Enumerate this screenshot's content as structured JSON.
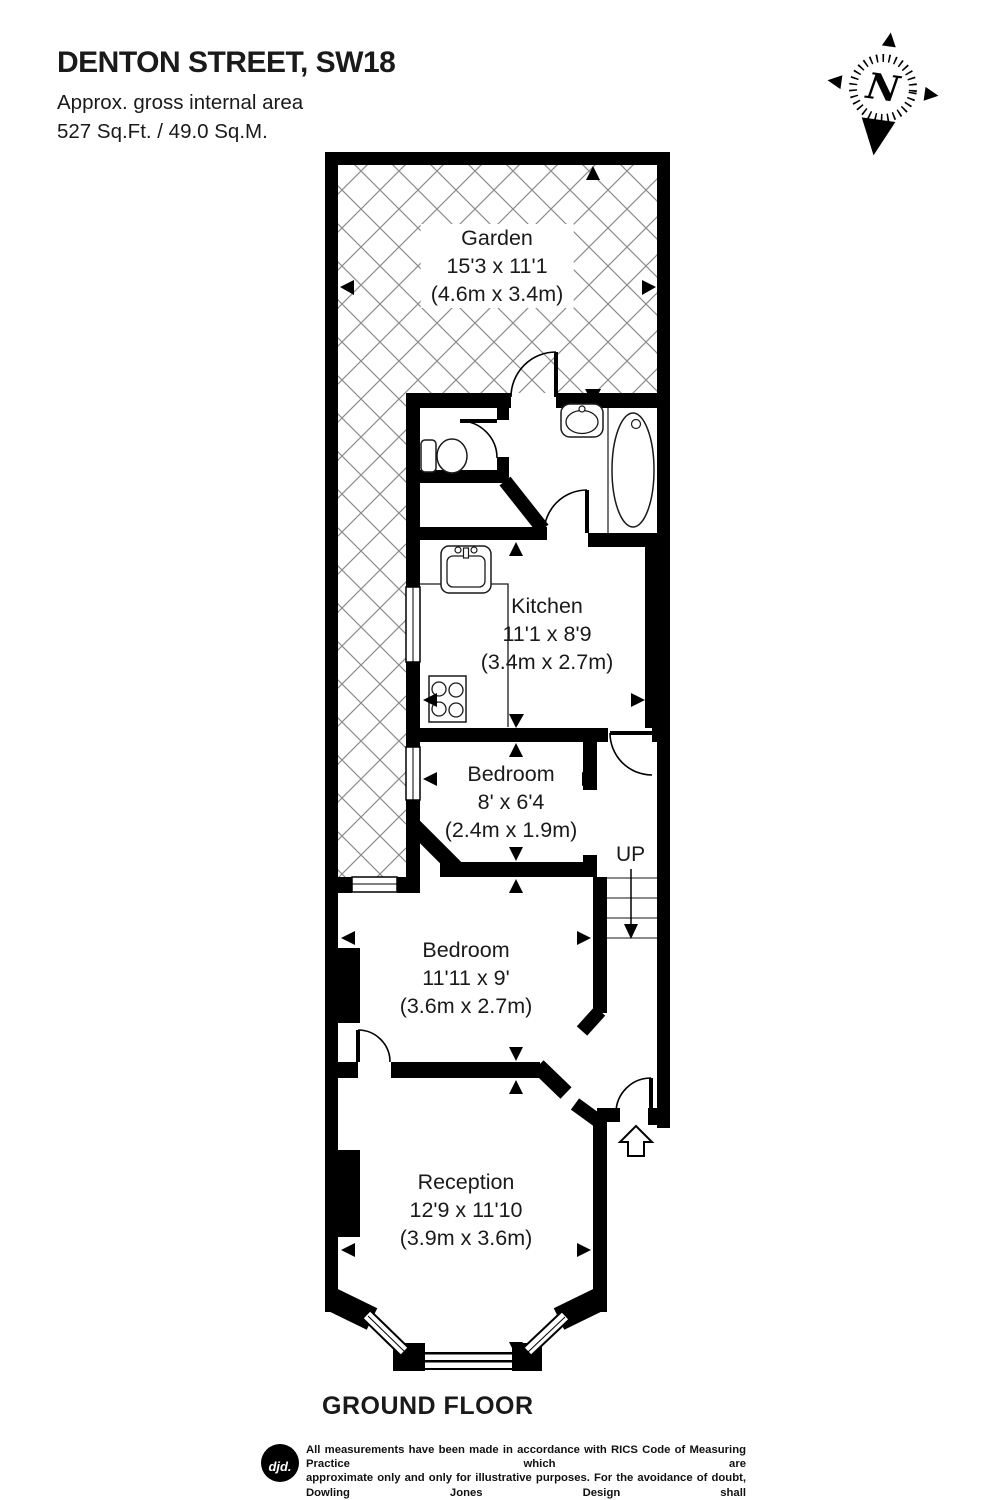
{
  "header": {
    "title": "DENTON STREET, SW18",
    "area_line1": "Approx. gross internal area",
    "area_line2": "527 Sq.Ft. / 49.0 Sq.M."
  },
  "compass": {
    "label": "N"
  },
  "rooms": {
    "garden": {
      "name": "Garden",
      "imperial": "15'3 x 11'1",
      "metric": "(4.6m x 3.4m)"
    },
    "kitchen": {
      "name": "Kitchen",
      "imperial": "11'1 x 8'9",
      "metric": "(3.4m x 2.7m)"
    },
    "bedroom_small": {
      "name": "Bedroom",
      "imperial": "8' x 6'4",
      "metric": "(2.4m x 1.9m)"
    },
    "bedroom_large": {
      "name": "Bedroom",
      "imperial": "11'11 x 9'",
      "metric": "(3.6m x 2.7m)"
    },
    "reception": {
      "name": "Reception",
      "imperial": "12'9 x 11'10",
      "metric": "(3.9m x 3.6m)"
    }
  },
  "stairs": {
    "label": "UP"
  },
  "floor": {
    "label": "GROUND FLOOR"
  },
  "footer": {
    "logo": "djd.",
    "line1": "All measurements have been made in accordance with RICS Code of Measuring Practice which are",
    "line2": "approximate only and only for illustrative purposes. For the avoidance of doubt, Dowling Jones Design shall",
    "line3": "not be liable for any reliance on these measurements. © 2015 www.dowlingjones.com 020 7610 9933"
  },
  "colors": {
    "wall": "#000000",
    "hatch": "#8c8c8c",
    "fixture_stroke": "#1a1a1a"
  }
}
